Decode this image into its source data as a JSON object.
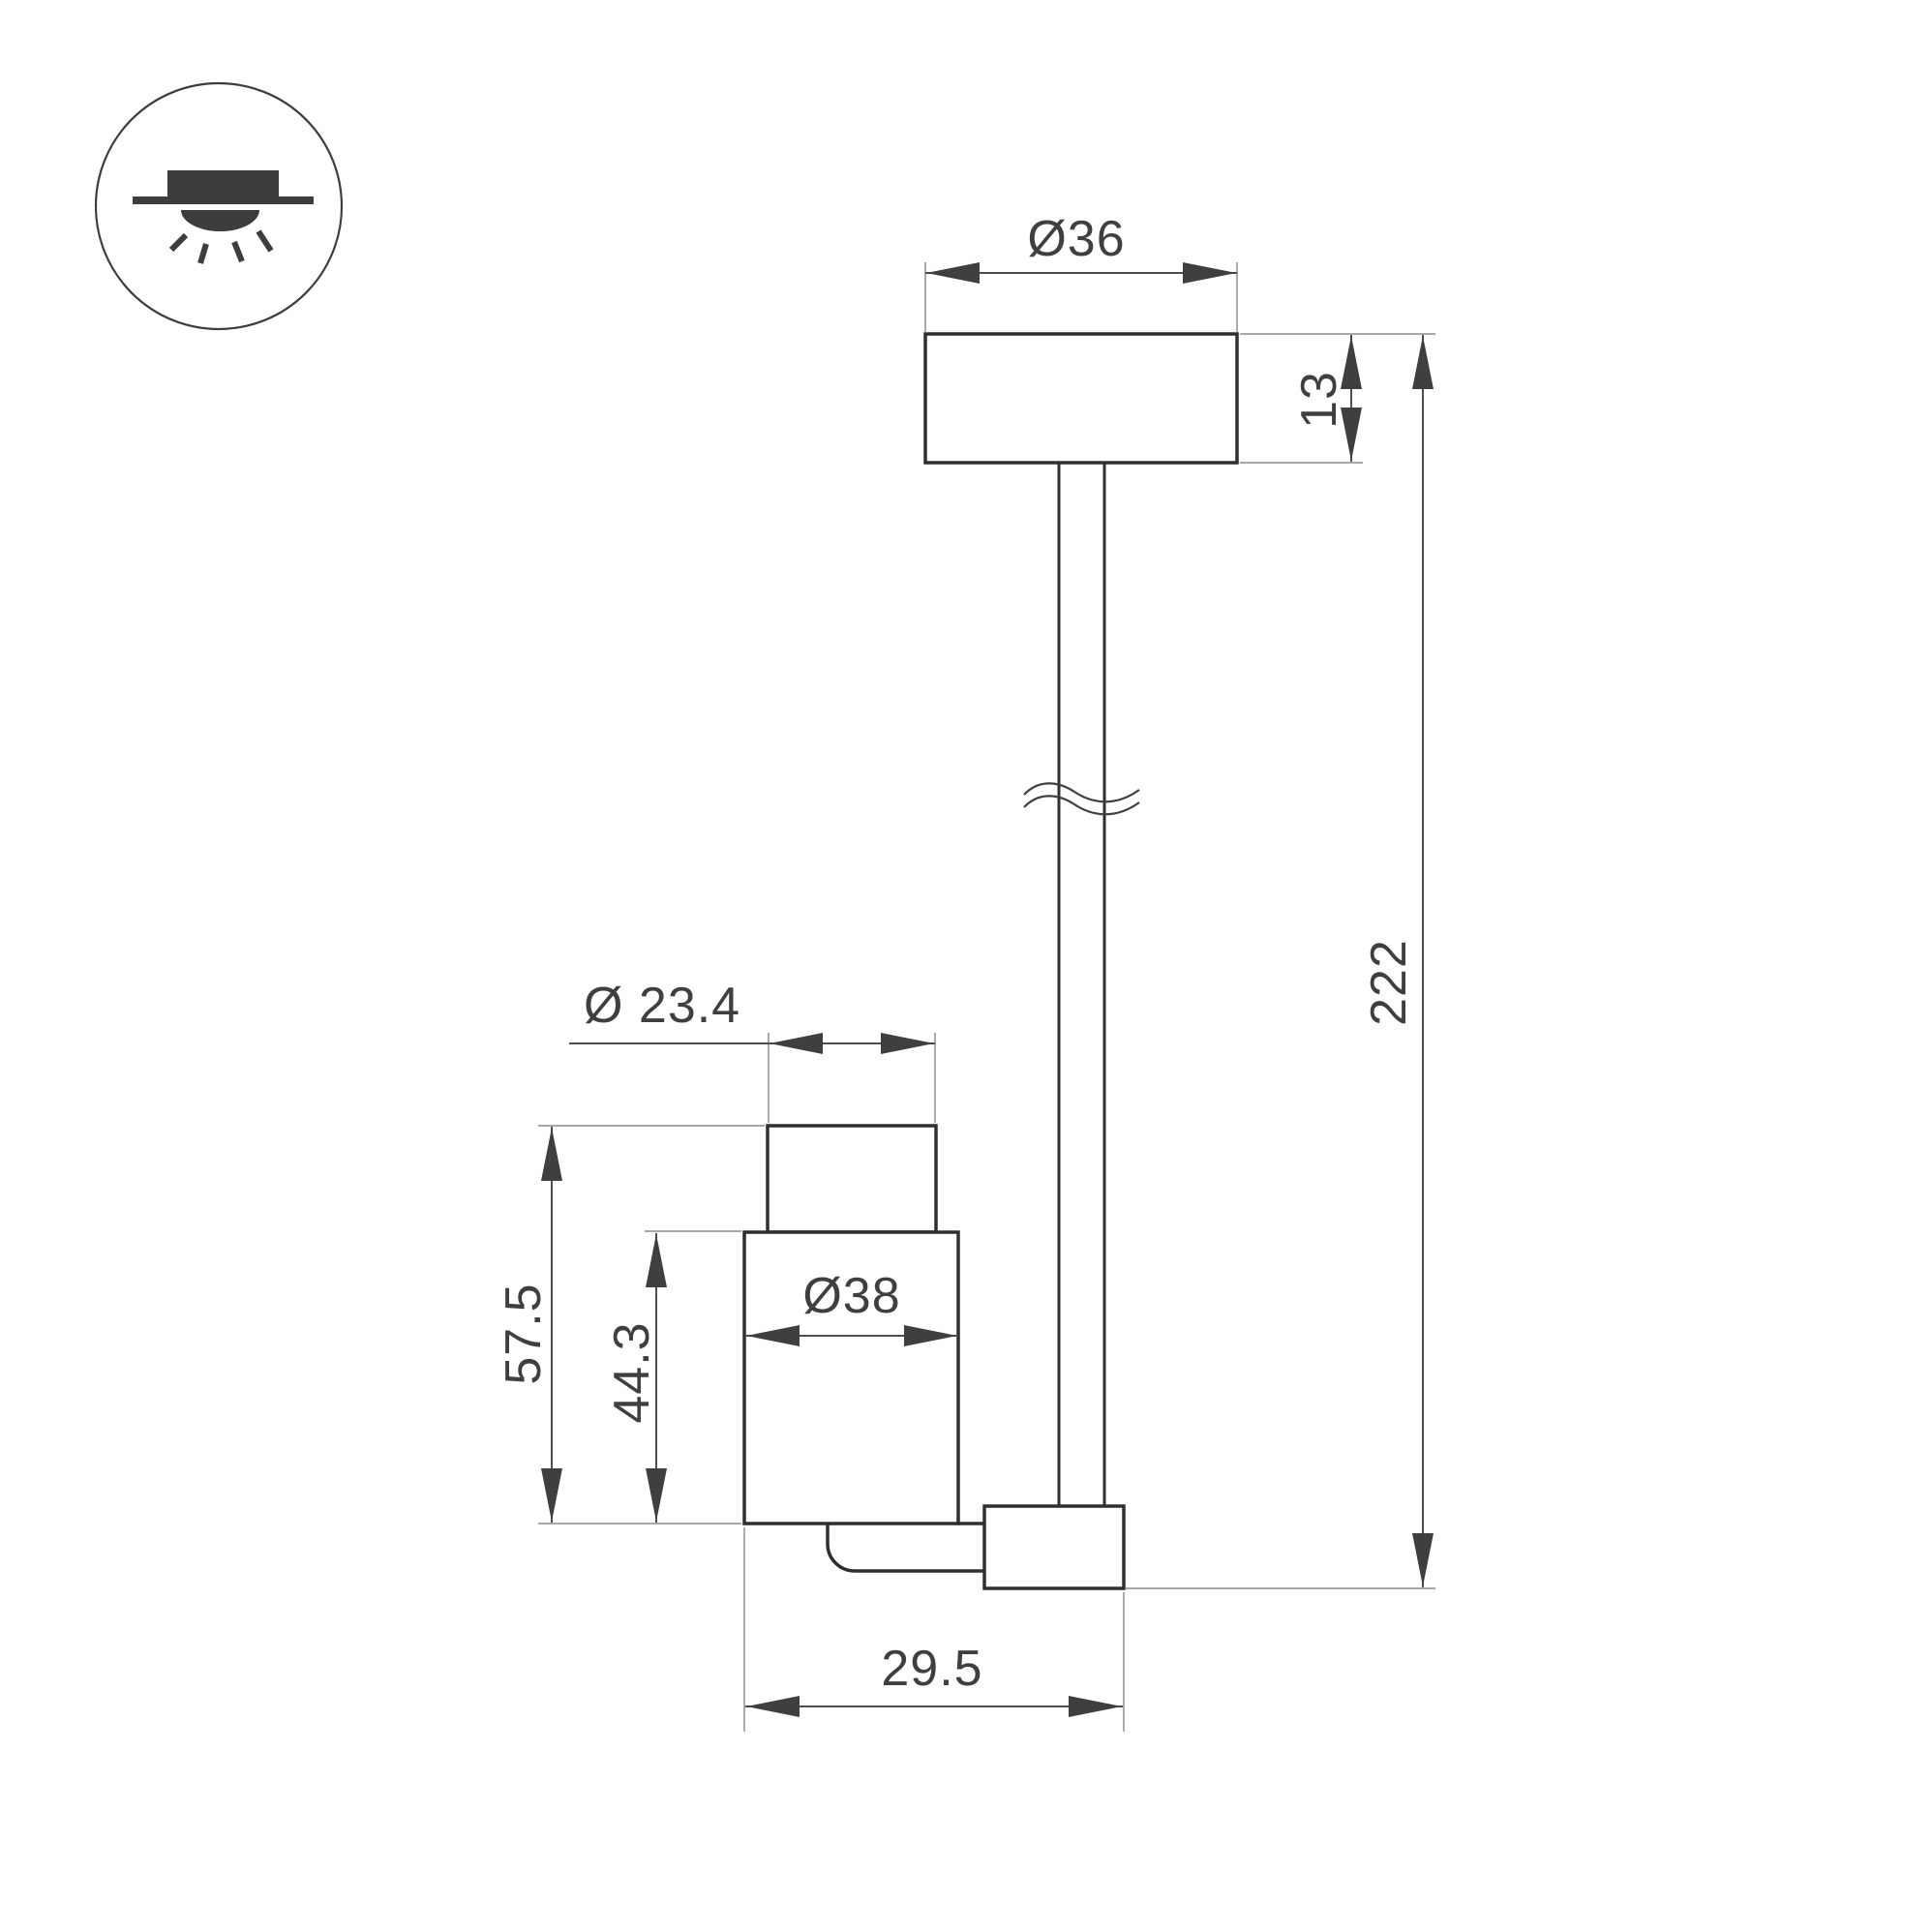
{
  "drawing": {
    "type": "luminaire-dimension-drawing",
    "icon": "surface-mounted-ceiling-light",
    "labels": {
      "canopy_diameter": "Ø36",
      "canopy_height": "13",
      "overall_drop": "222",
      "spot_top_diameter": "Ø 23.4",
      "spot_total_height": "57.5",
      "spot_body_height": "44.3",
      "spot_body_diameter": "Ø38",
      "spot_depth": "29.5"
    },
    "colors": {
      "background": "#ffffff",
      "part_outline": "#2f2f2f",
      "dimension_line": "#4f4f4f",
      "extension_line": "#9b9b9b",
      "label_text": "#3f3f3f",
      "icon": "#3d3d3d"
    }
  }
}
